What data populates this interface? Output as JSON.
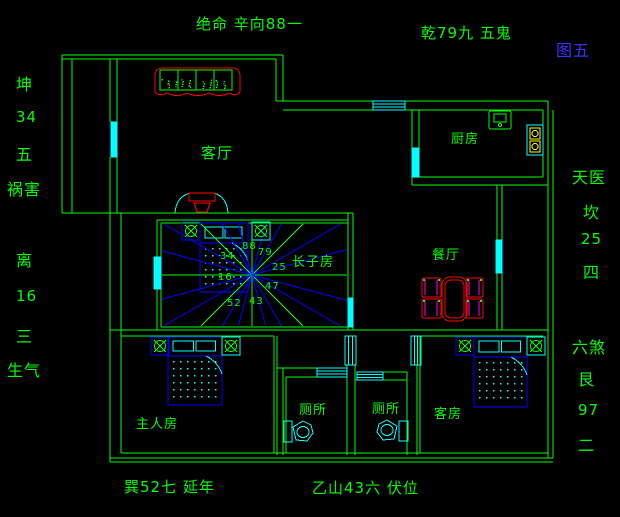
{
  "palette": {
    "background": "#000000",
    "wall_green": "#00ff00",
    "accent_cyan": "#00ffff",
    "accent_blue": "#0000ff",
    "accent_red": "#ff0000",
    "accent_magenta": "#ff00ff",
    "accent_yellow": "#ffff00",
    "figure_blue": "#3333ff"
  },
  "figure": {
    "number": "图五"
  },
  "annotations": {
    "top_center": "绝命 辛向88一",
    "top_right": "乾79九 五鬼",
    "left_column": [
      "坤",
      "34",
      "五",
      "祸害",
      "离",
      "16",
      "三",
      "生气"
    ],
    "right_column": [
      "天医",
      "坎",
      "25",
      "四",
      "六煞",
      "艮",
      "97",
      "二"
    ],
    "bottom": [
      "巽52七 延年",
      "乙山43六 伏位"
    ]
  },
  "rooms": [
    "客厅",
    "厨房",
    "餐厅",
    "长子房",
    "主人房",
    "厕所",
    "厕所",
    "客房"
  ],
  "star_numbers": [
    "88",
    "79",
    "25",
    "47",
    "43",
    "52",
    "34",
    "16"
  ],
  "labels": [
    {
      "n": "annotation-top-center",
      "t": "绝命 辛向88一",
      "x": 196,
      "y": 17,
      "fs": 15
    },
    {
      "n": "annotation-top-right",
      "t": "乾79九 五鬼",
      "x": 421,
      "y": 26,
      "fs": 15
    },
    {
      "n": "figure-number",
      "t": "图五",
      "x": 556,
      "y": 43,
      "fs": 16,
      "c": "#3333ff"
    },
    {
      "n": "side-kun",
      "t": "坤",
      "x": 16,
      "y": 77,
      "fs": 16
    },
    {
      "n": "side-kun-number",
      "t": "34",
      "x": 16,
      "y": 110,
      "fs": 15
    },
    {
      "n": "side-kun-five",
      "t": "五",
      "x": 16,
      "y": 147,
      "fs": 16
    },
    {
      "n": "side-huohai",
      "t": "祸害",
      "x": 7,
      "y": 182,
      "fs": 16
    },
    {
      "n": "side-li",
      "t": "离",
      "x": 16,
      "y": 253,
      "fs": 16
    },
    {
      "n": "side-li-number",
      "t": "16",
      "x": 16,
      "y": 289,
      "fs": 15
    },
    {
      "n": "side-li-three",
      "t": "三",
      "x": 16,
      "y": 329,
      "fs": 16
    },
    {
      "n": "side-shengqi",
      "t": "生气",
      "x": 7,
      "y": 363,
      "fs": 16
    },
    {
      "n": "side-tianyi",
      "t": "天医",
      "x": 572,
      "y": 170,
      "fs": 16
    },
    {
      "n": "side-kan",
      "t": "坎",
      "x": 583,
      "y": 205,
      "fs": 16
    },
    {
      "n": "side-kan-number",
      "t": "25",
      "x": 581,
      "y": 232,
      "fs": 15
    },
    {
      "n": "side-kan-four",
      "t": "四",
      "x": 583,
      "y": 265,
      "fs": 16
    },
    {
      "n": "side-liusha",
      "t": "六煞",
      "x": 572,
      "y": 340,
      "fs": 16
    },
    {
      "n": "side-gen",
      "t": "艮",
      "x": 578,
      "y": 372,
      "fs": 16
    },
    {
      "n": "side-gen-number",
      "t": "97",
      "x": 578,
      "y": 403,
      "fs": 15
    },
    {
      "n": "side-gen-two",
      "t": "二",
      "x": 578,
      "y": 438,
      "fs": 16
    },
    {
      "n": "annotation-bottom-left",
      "t": "巽52七 延年",
      "x": 124,
      "y": 480,
      "fs": 15
    },
    {
      "n": "annotation-bottom-center",
      "t": "乙山43六 伏位",
      "x": 312,
      "y": 481,
      "fs": 15
    },
    {
      "n": "room-living",
      "t": "客厅",
      "x": 201,
      "y": 146,
      "fs": 15
    },
    {
      "n": "room-kitchen",
      "t": "厨房",
      "x": 451,
      "y": 133,
      "fs": 13
    },
    {
      "n": "room-dining",
      "t": "餐厅",
      "x": 432,
      "y": 249,
      "fs": 13
    },
    {
      "n": "room-eldest-son",
      "t": "长子房",
      "x": 292,
      "y": 256,
      "fs": 13
    },
    {
      "n": "room-master",
      "t": "主人房",
      "x": 136,
      "y": 418,
      "fs": 13
    },
    {
      "n": "room-toilet-left",
      "t": "厕所",
      "x": 299,
      "y": 404,
      "fs": 13
    },
    {
      "n": "room-toilet-right",
      "t": "厕所",
      "x": 372,
      "y": 403,
      "fs": 13
    },
    {
      "n": "room-guest",
      "t": "客房",
      "x": 434,
      "y": 408,
      "fs": 13
    },
    {
      "n": "star-number-88",
      "t": "88",
      "x": 242,
      "y": 242,
      "fs": 10
    },
    {
      "n": "star-number-79",
      "t": "79",
      "x": 258,
      "y": 248,
      "fs": 10
    },
    {
      "n": "star-number-25",
      "t": "25",
      "x": 272,
      "y": 263,
      "fs": 10
    },
    {
      "n": "star-number-47",
      "t": "47",
      "x": 265,
      "y": 282,
      "fs": 10
    },
    {
      "n": "star-number-43",
      "t": "43",
      "x": 249,
      "y": 297,
      "fs": 10
    },
    {
      "n": "star-number-52",
      "t": "52",
      "x": 227,
      "y": 299,
      "fs": 10
    },
    {
      "n": "star-number-34",
      "t": "34",
      "x": 220,
      "y": 252,
      "fs": 10
    },
    {
      "n": "star-number-16",
      "t": "16",
      "x": 218,
      "y": 273,
      "fs": 10
    }
  ]
}
